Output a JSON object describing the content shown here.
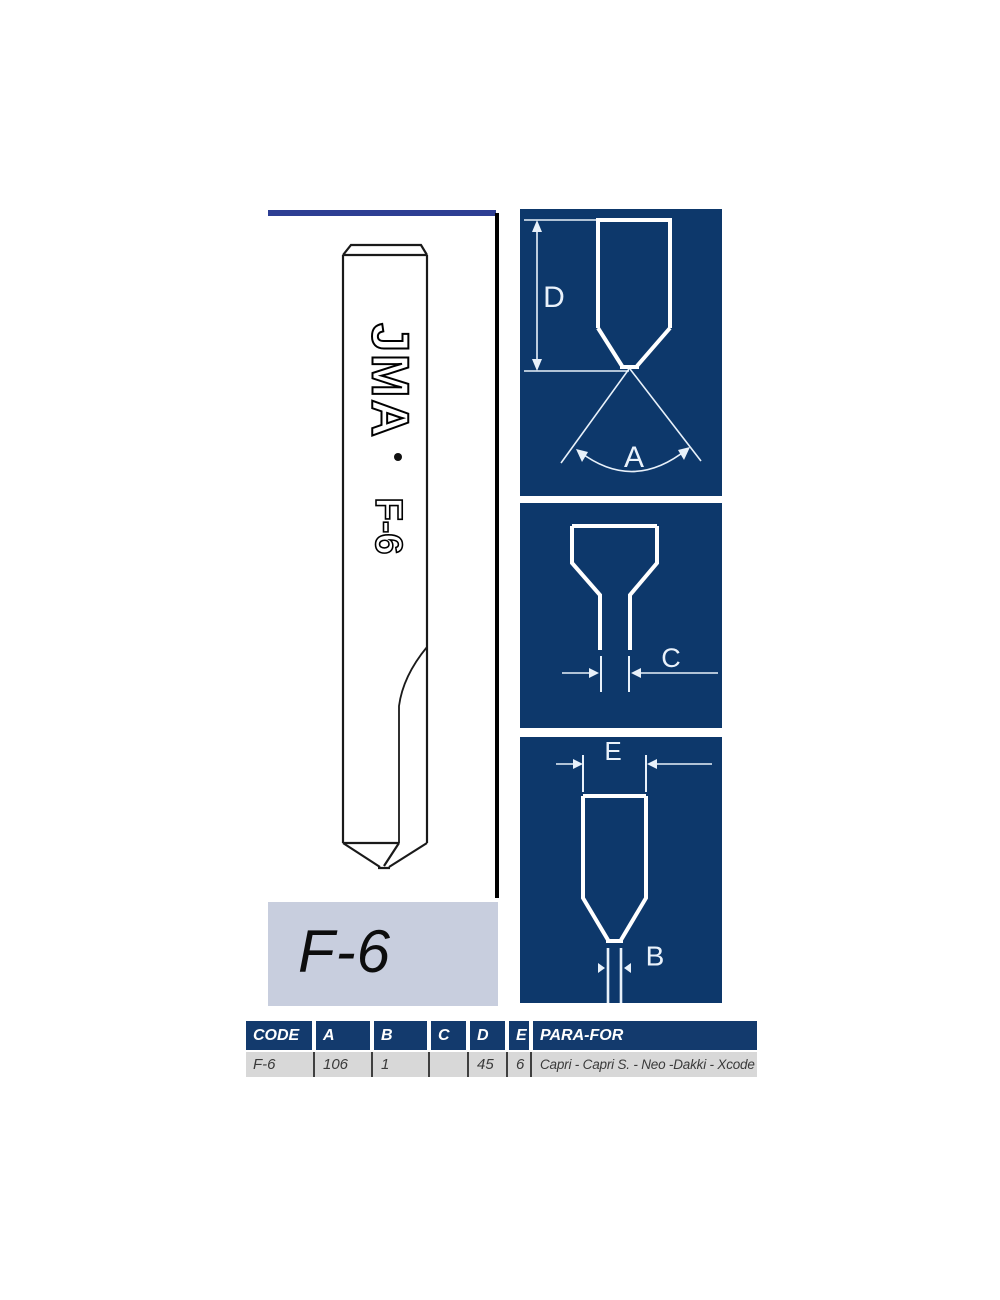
{
  "cutter_drawing": {
    "brand": "JMA",
    "model": "F-6"
  },
  "model_plate": {
    "label": "F-6"
  },
  "diagrams": {
    "profile": {
      "depth_label": "D",
      "angle_label": "A"
    },
    "front": {
      "width_label": "C"
    },
    "side": {
      "head_width_label": "E",
      "tip_width_label": "B"
    }
  },
  "spec_table": {
    "headers": [
      "CODE",
      "A",
      "B",
      "C",
      "D",
      "E",
      "PARA-FOR"
    ],
    "row": [
      "F-6",
      "106",
      "1",
      "",
      "45",
      "6",
      "Capri - Capri S. - Neo -Dakki - Xcode"
    ]
  },
  "colors": {
    "panel_navy": "#0d386b",
    "header_navy": "#133a6d",
    "accent_bar": "#2d3e93",
    "plate_gray": "#c8cede",
    "row_gray": "#d8d8d8"
  }
}
